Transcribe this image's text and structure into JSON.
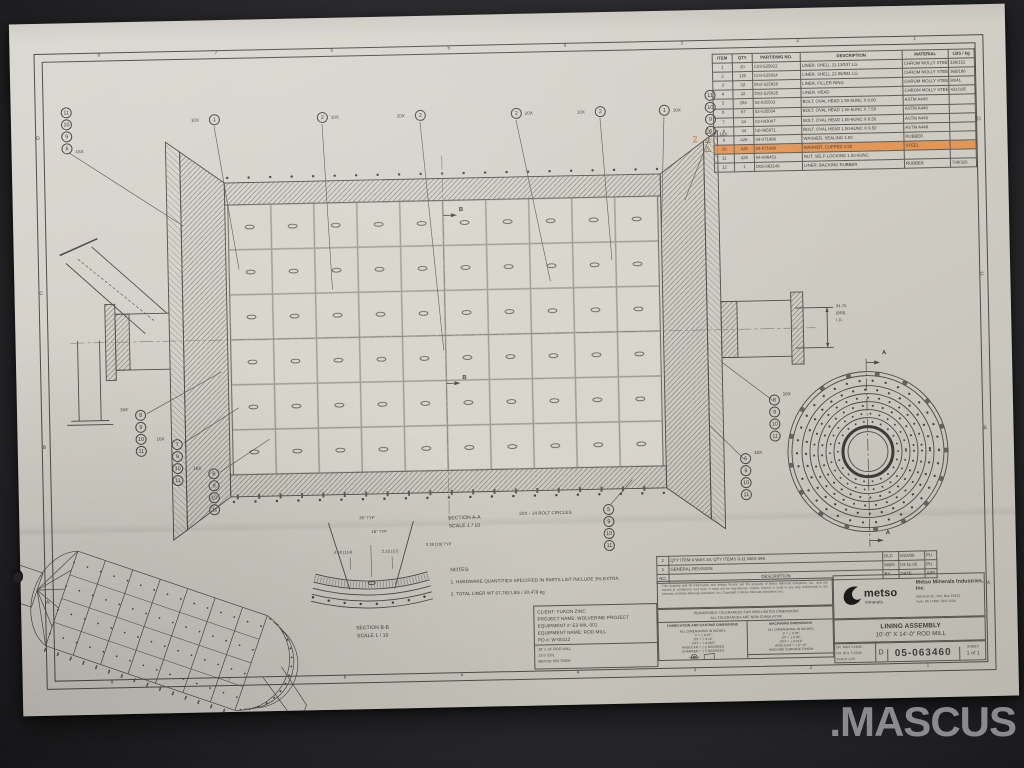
{
  "photo": {
    "watermark": ".MASCUS"
  },
  "border": {
    "zones_top": [
      "8",
      "7",
      "6",
      "5",
      "4",
      "3",
      "2",
      "1"
    ],
    "zones_bottom": [
      "8",
      "7",
      "6",
      "5",
      "4",
      "3",
      "2",
      "1"
    ],
    "zones_left": [
      "D",
      "C",
      "B",
      "A"
    ],
    "zones_right": [
      "D",
      "C",
      "B",
      "A"
    ]
  },
  "parts_list": {
    "headers": [
      "ITEM",
      "QTY",
      "PART/DWG NO.",
      "DESCRIPTION",
      "MATERIAL",
      "LBS / kg"
    ],
    "rows": [
      [
        "1",
        "20",
        "C03-525822",
        "LINER, SHELL  21.13/537 LG",
        "CHROM MOLLY STEEL",
        "336/152"
      ],
      [
        "2",
        "120",
        "C03-525824",
        "LINER, SHELL  22.86/581 LG",
        "CHROM MOLLY STEEL",
        "365/166"
      ],
      [
        "3",
        "32",
        "D03-525826",
        "LINER, FILLER RING",
        "CHROM MOLLY STEEL",
        "90/41"
      ],
      [
        "4",
        "32",
        "D03-525825",
        "LINER, HEAD",
        "CHROM MOLLY STEEL",
        "431/195"
      ],
      [
        "5",
        "294",
        "02-035503",
        "BOLT, OVAL HEAD 1.50-6UNC X 6.00",
        "ASTM A449",
        ""
      ],
      [
        "6",
        "67",
        "02-035504",
        "BOLT, OVAL HEAD 1.50-6UNC X 7.50",
        "ASTM A449",
        ""
      ],
      [
        "7",
        "34",
        "02-043047",
        "BOLT, OVAL HEAD 1.50-6UNC X 8.50",
        "ASTM A449",
        ""
      ],
      [
        "8",
        "34",
        "02-065971",
        "BOLT, OVAL HEAD 1.50-6UNC X 9.50",
        "ASTM A449",
        ""
      ],
      [
        "9",
        "428",
        "04-071966",
        "WASHER, SEALING  1.50",
        "RUBBER",
        ""
      ],
      [
        "10",
        "428",
        "04-071960",
        "WASHER, CUPPED  1.50",
        "STEEL",
        ""
      ],
      [
        "11",
        "428",
        "04-086451",
        "NUT, SELF-LOCKING 1.50-6UNC",
        "",
        ""
      ],
      [
        "12",
        "1",
        "D05-063146",
        "LINER, BACKING RUBBER",
        "RUBBER",
        "706/320"
      ]
    ]
  },
  "annotations": {
    "rev_triangle": "2",
    "handwritten": "2"
  },
  "callouts": {
    "top": [
      {
        "num": "1",
        "qty": "10X"
      },
      {
        "num": "2",
        "qty": "10X"
      },
      {
        "num": "2",
        "qty": "20X"
      },
      {
        "num": "2",
        "qty": "20X"
      },
      {
        "num": "2",
        "qty": "10X"
      },
      {
        "num": "1",
        "qty": "10X"
      }
    ],
    "stack_qty": "16X",
    "top_left_stack": [
      "11",
      "10",
      "9",
      "6"
    ],
    "top_right_stack": [
      "11",
      "10",
      "9",
      "6"
    ],
    "bottom_left_stacks": [
      [
        "8",
        "9",
        "10",
        "11"
      ],
      [
        "7",
        "9",
        "10",
        "11"
      ],
      [
        "6",
        "9",
        "10",
        "11"
      ]
    ],
    "bottom_right_stacks": [
      [
        "8",
        "9",
        "10",
        "11"
      ],
      [
        "6",
        "9",
        "10",
        "11"
      ]
    ],
    "bolt_circle_stack": [
      "5",
      "9",
      "10",
      "11"
    ]
  },
  "labels": {
    "section_a": "SECTION  A-A",
    "section_a_scale": "SCALE 1 / 10",
    "section_b": "SECTION  B-B",
    "section_b_scale": "SCALE 1 / 10",
    "notes_title": "NOTES:",
    "note1": "1.   HARDWARE QUANTITIES SPECIFIED IN PARTS LIST INCLUDE 3% EXTRA.",
    "note2": "2.   TOTAL LINER WT 67,782 LBS / 30,478 kg",
    "bolt_circles": "20X - 14 BOLT CIRCLES",
    "cut_a": "A",
    "cut_b": "B",
    "dim_bore_in": "34.75",
    "dim_bore_mm": "[883]",
    "dim_bore_suffix": "I.D.",
    "bb_dim_36": "36\" TYP",
    "bb_dim_18": "18\" TYP",
    "bb_dim_450": "4.50 [114]",
    "bb_dim_225": "2.25 [57]",
    "bb_dim_038": "0.38 [10] TYP"
  },
  "revision_block": {
    "rows": [
      [
        "2",
        "QTY ITEM 4 WAS 34;  QTY ITEMS 9-11 WAS 396",
        "DLC",
        "6/23/06",
        "PU"
      ],
      [
        "1",
        "GENERAL REVISION",
        "MWS",
        "03-11-05",
        "PU"
      ],
      [
        "NO.",
        "DESCRIPTION",
        "BY",
        "DATE",
        "APP"
      ]
    ]
  },
  "proprietary": "This drawing and all information and design hereon are the property of Metso Minerals Industries, Inc., and are loaned in confidence and trust. It must not be reproduced, copied, loaned or used in any way detrimental to the interests of Metso Minerals Industries, Inc.  Copyright © Metso Minerals Industries, Inc.",
  "tolerances": {
    "header1": "PERMISSIBLE TOLERANCES FOR NON-LIMITED DIMENSIONS",
    "header2": "ALL TOLERANCES ARE NON-CUMULATIVE",
    "fab_title": "FABRICATION AND CASTING DIMENSIONS",
    "fab_lines": [
      "ALL DIMENSIONS IN INCHES",
      ".X = ± 0.25\"",
      ".XX = ± 0.12\"",
      ".XXX = ± 0.062\"",
      "ANGULAR = ± 2 DEGREES",
      "CHAMFER = ± 5 DEGREES"
    ],
    "mach_title": "MACHINING DIMENSIONS",
    "mach_lines": [
      "ALL DIMENSIONS IN INCHES",
      ".X = ± 0.06\"",
      ".XX = ± 0.02\"",
      ".XXX = ± 0.010\"",
      "ANGULAR = ± 0°-15'",
      "MACHINE SURFACE FINISH",
      "250 RMS - UNLESS NOTED"
    ],
    "do_not_scale": "DO NOT SCALE"
  },
  "title_block": {
    "company": {
      "logo_word": "metso",
      "logo_sub": "minerals",
      "name": "Metso Minerals Industries, Inc.",
      "addr1": "240 Arch St., P.O. Box 15312",
      "addr2": "York, PA 17405-7312 USA"
    },
    "title1": "LINING ASSEMBLY",
    "title2": "10'-0\" X 14'-0\" ROD MILL",
    "size": "D",
    "dwg_no": "05-063460",
    "sheet_label": "SHEET",
    "sheet_value": "1 of 1",
    "meta_rows": [
      [
        "DR. MJN",
        "7/13/06"
      ],
      [
        "CH. DLS",
        "7/13/06"
      ],
      [
        "SCALE",
        "1:25"
      ]
    ]
  },
  "client_block": {
    "lines": [
      "CLIENT:  YUKON ZINC",
      "PROJECT NAME:  WOLVERINE PROJECT",
      "EQUIPMENT #:  E2-MIL-001",
      "EQUIPMENT NAME:  ROD MILL",
      "PO #:  W-00112"
    ],
    "sub_lines": [
      "10' x 14' ROD MILL",
      "13.5' EGL",
      "METSO S/N 75906"
    ]
  }
}
